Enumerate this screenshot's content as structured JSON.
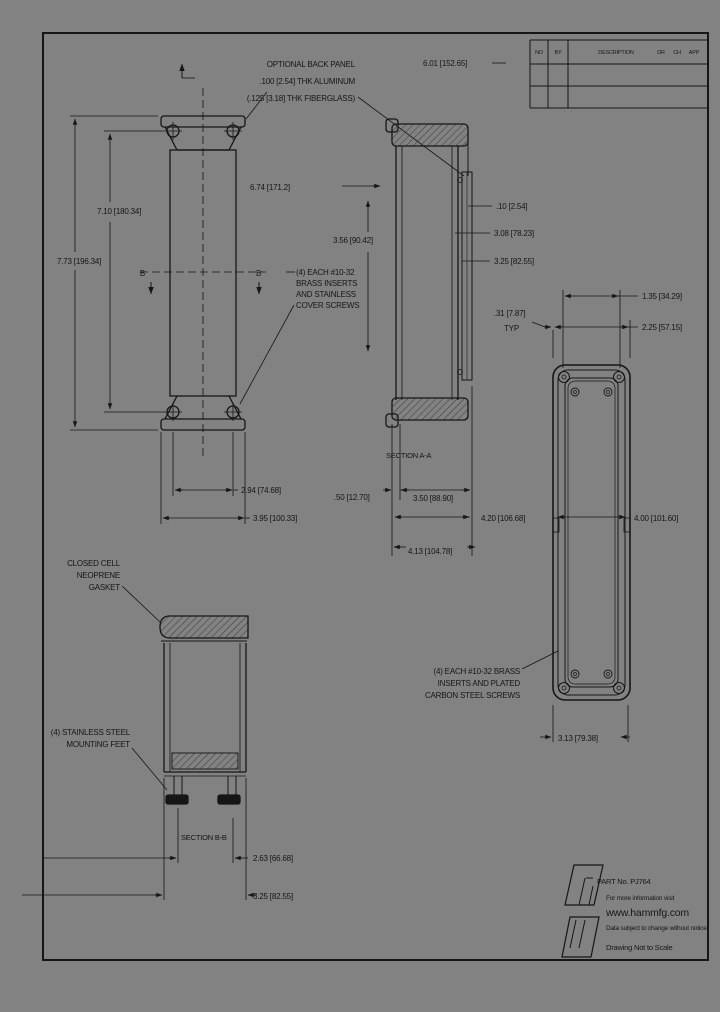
{
  "colors": {
    "background": "#828282",
    "line": "#161616"
  },
  "revision_table": {
    "col_no": "NO",
    "col_by": "BY",
    "col_desc": "DESCRIPTION",
    "col_dr": "DR",
    "col_ch": "CH",
    "col_app": "APP"
  },
  "notes": {
    "back_panel": [
      "OPTIONAL BACK PANEL",
      ".100 [2.54] THK ALUMINUM",
      "(.125 [3.18] THK FIBERGLASS)"
    ],
    "inserts_top": [
      "(4) EACH #10-32",
      "BRASS INSERTS",
      "AND STAINLESS",
      "COVER SCREWS"
    ],
    "gasket": [
      "CLOSED CELL",
      "NEOPRENE",
      "GASKET"
    ],
    "feet": [
      "(4) STAINLESS STEEL",
      "MOUNTING FEET"
    ],
    "inserts_bottom": [
      "(4) EACH #10-32 BRASS",
      "INSERTS AND PLATED",
      "CARBON STEEL SCREWS"
    ]
  },
  "sections": {
    "a": "SECTION A-A",
    "b": "SECTION B-B"
  },
  "view_letters": {
    "left": "B",
    "right": "B"
  },
  "dimensions": {
    "top_width": "6.01 [152.65]",
    "lid_width": "6.74 [171.2]",
    "hole_span_v": "7.10 [180.34]",
    "overall_v": "7.73 [196.34]",
    "panel_height": "3.56 [90.42]",
    "panel_thk": ".10 [2.54]",
    "dim_308": "3.08 [78.23]",
    "dim_325_side": "3.25 [82.55]",
    "hole_span_h": "2.94 [74.68]",
    "overall_h": "3.95 [100.33]",
    "dim_050": ".50 [12.70]",
    "dim_350": "3.50 [88.90]",
    "dim_413": "4.13 [104.78]",
    "dim_420": "4.20 [106.68]",
    "dim_400": "4.00 [101.60]",
    "dim_135": "1.35 [34.29]",
    "dim_225": "2.25 [57.15]",
    "dim_031": ".31 [7.87]",
    "typ": "TYP",
    "dim_313": "3.13 [79.38]",
    "dim_263": "2.63 [66.68]",
    "dim_325_bottom": "3.25 [82.55]"
  },
  "logo": {
    "part_no": "PART No. PJ764",
    "info": "For more information visit",
    "url": "www.hammfg.com",
    "disclaimer": "Data subject to change without notice",
    "scale_note": "Drawing Not to Scale"
  }
}
